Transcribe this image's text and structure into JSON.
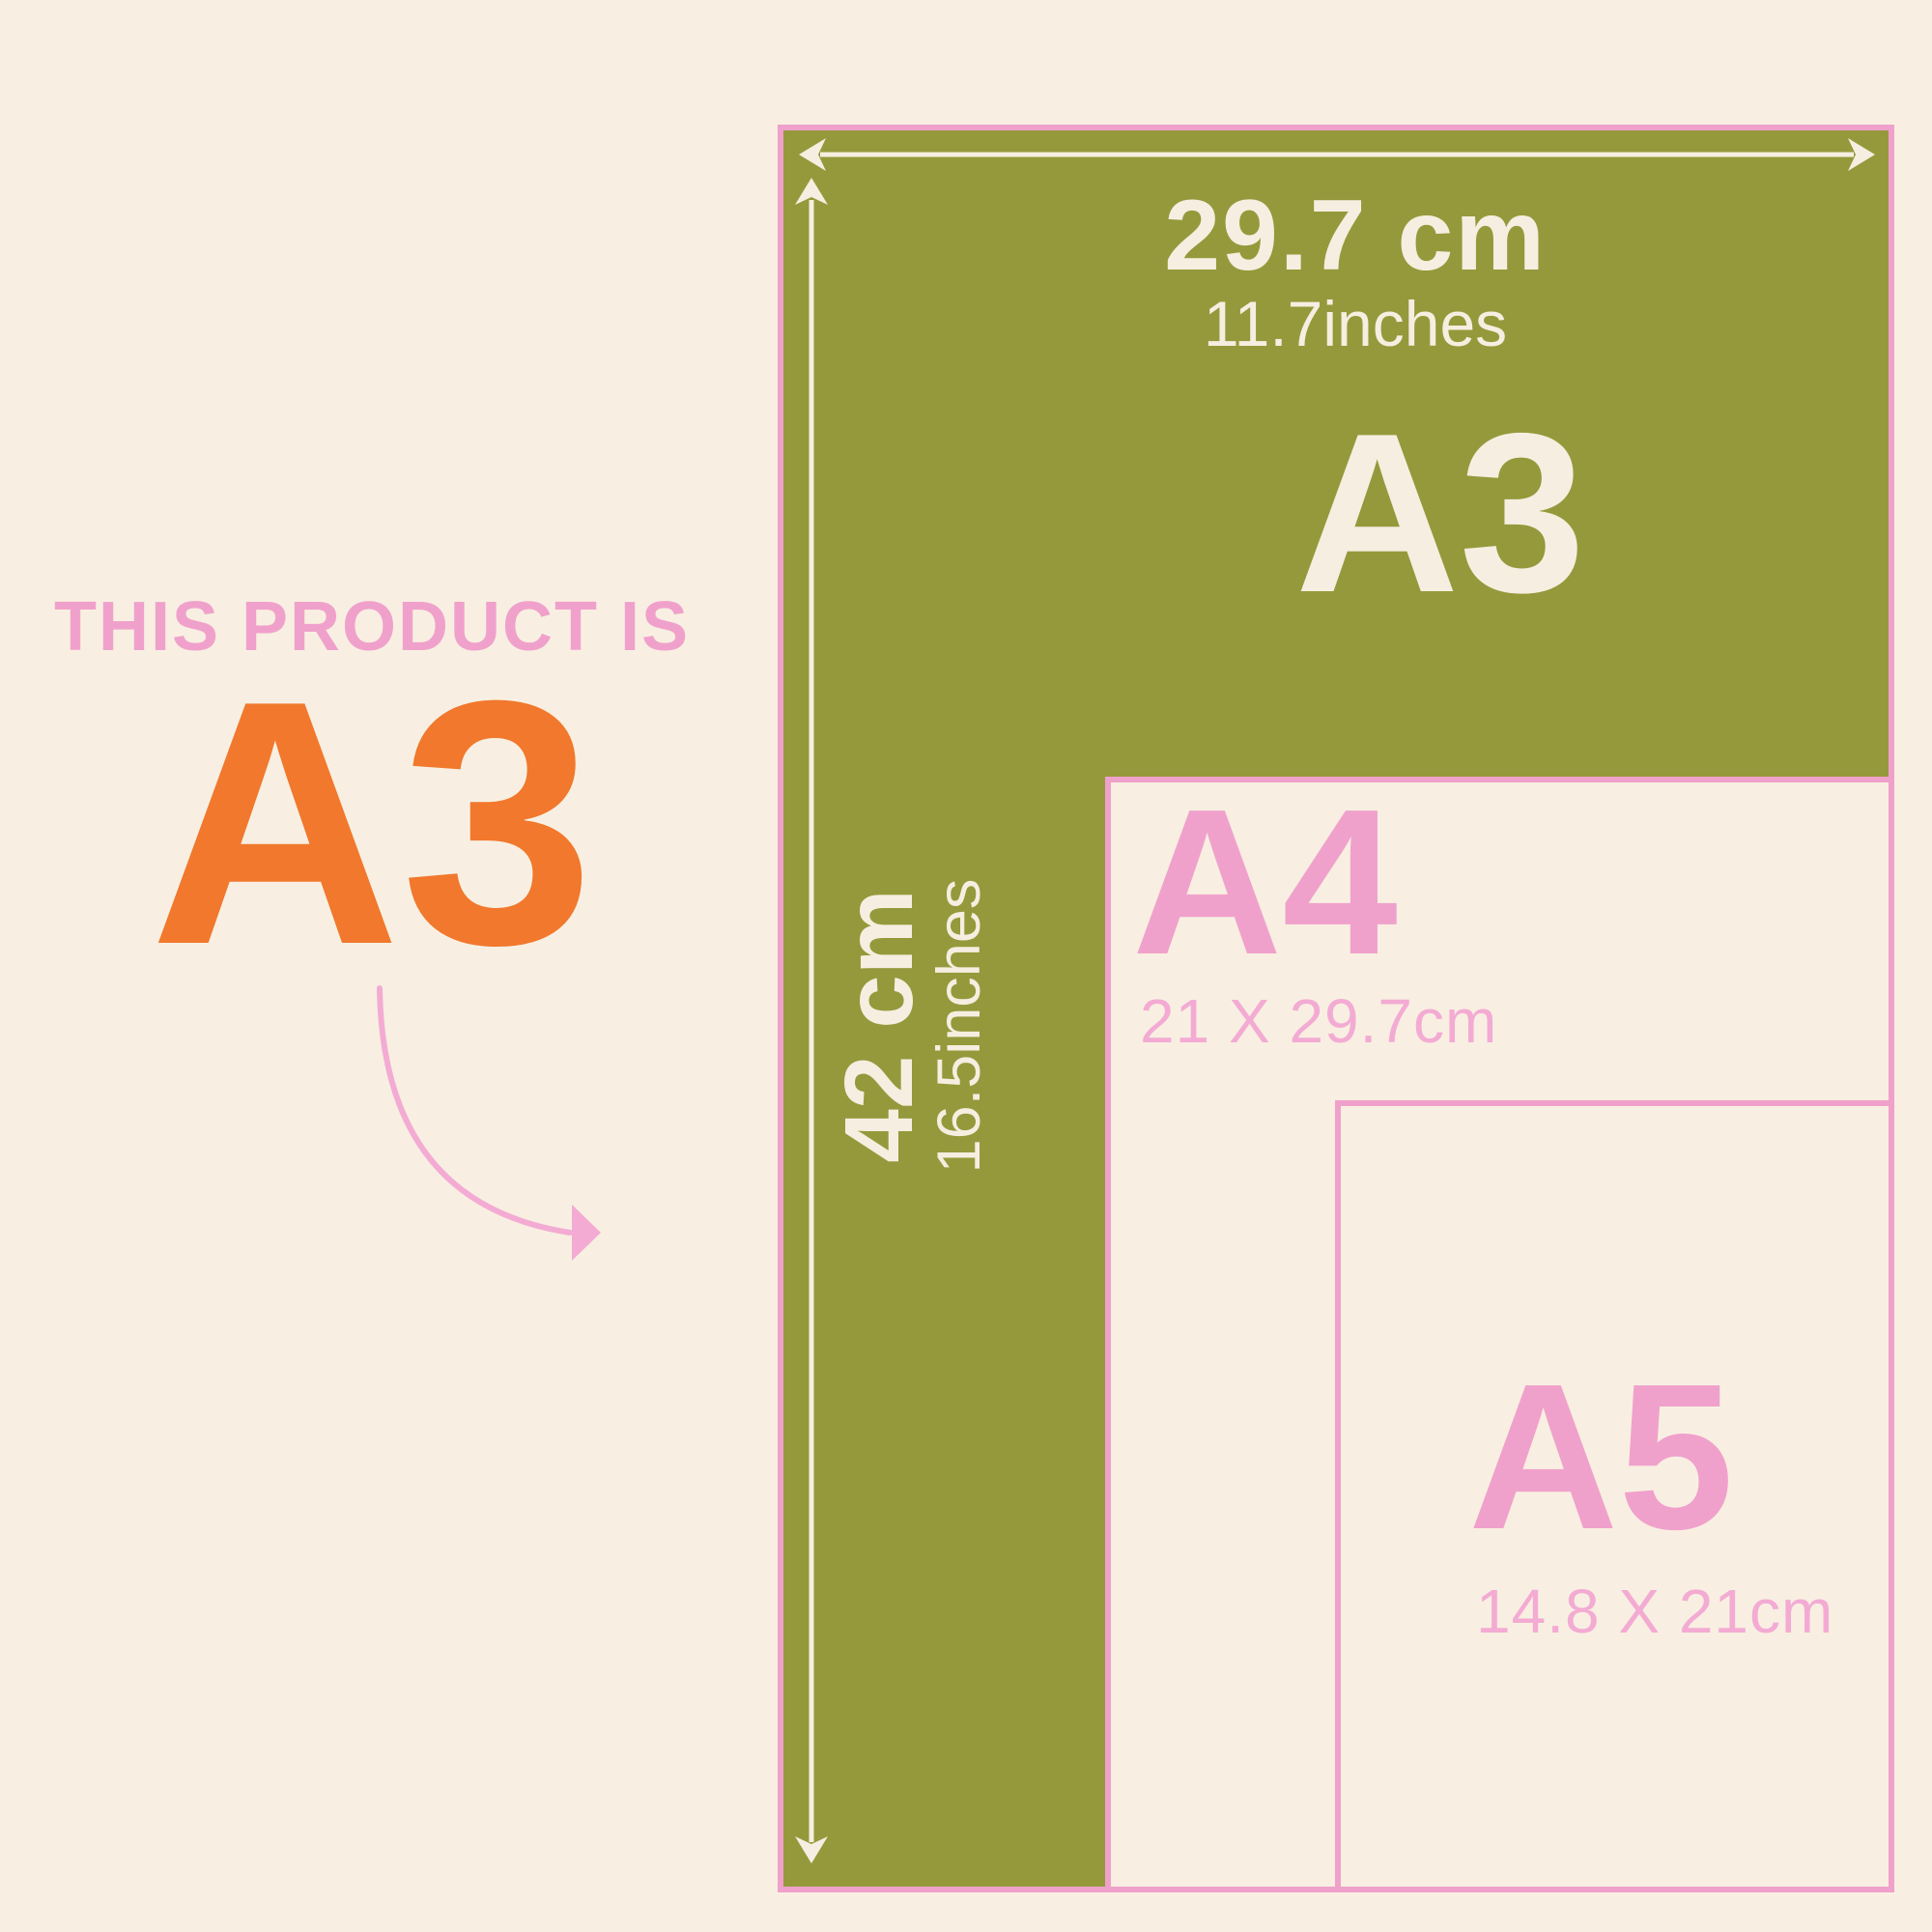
{
  "colors": {
    "cream-bg": "#F8EFE2",
    "cream": "#F6EEE0",
    "green": "#95993B",
    "pink": "#F0A1CB",
    "pink-light": "#F3ABD3",
    "orange": "#F1782C"
  },
  "callout": {
    "eyebrow": "THIS PRODUCT IS",
    "product_size": "A3"
  },
  "diagram": {
    "width_measure": {
      "value": "29.7 cm",
      "inches": "11.7inches"
    },
    "height_measure": {
      "value": "42 cm",
      "inches": "16.5inches"
    },
    "sheets": [
      {
        "name": "A3",
        "label": "A3"
      },
      {
        "name": "A4",
        "label": "A4",
        "dimensions": "21 X 29.7cm"
      },
      {
        "name": "A5",
        "label": "A5",
        "dimensions": "14.8 X 21cm"
      }
    ]
  }
}
